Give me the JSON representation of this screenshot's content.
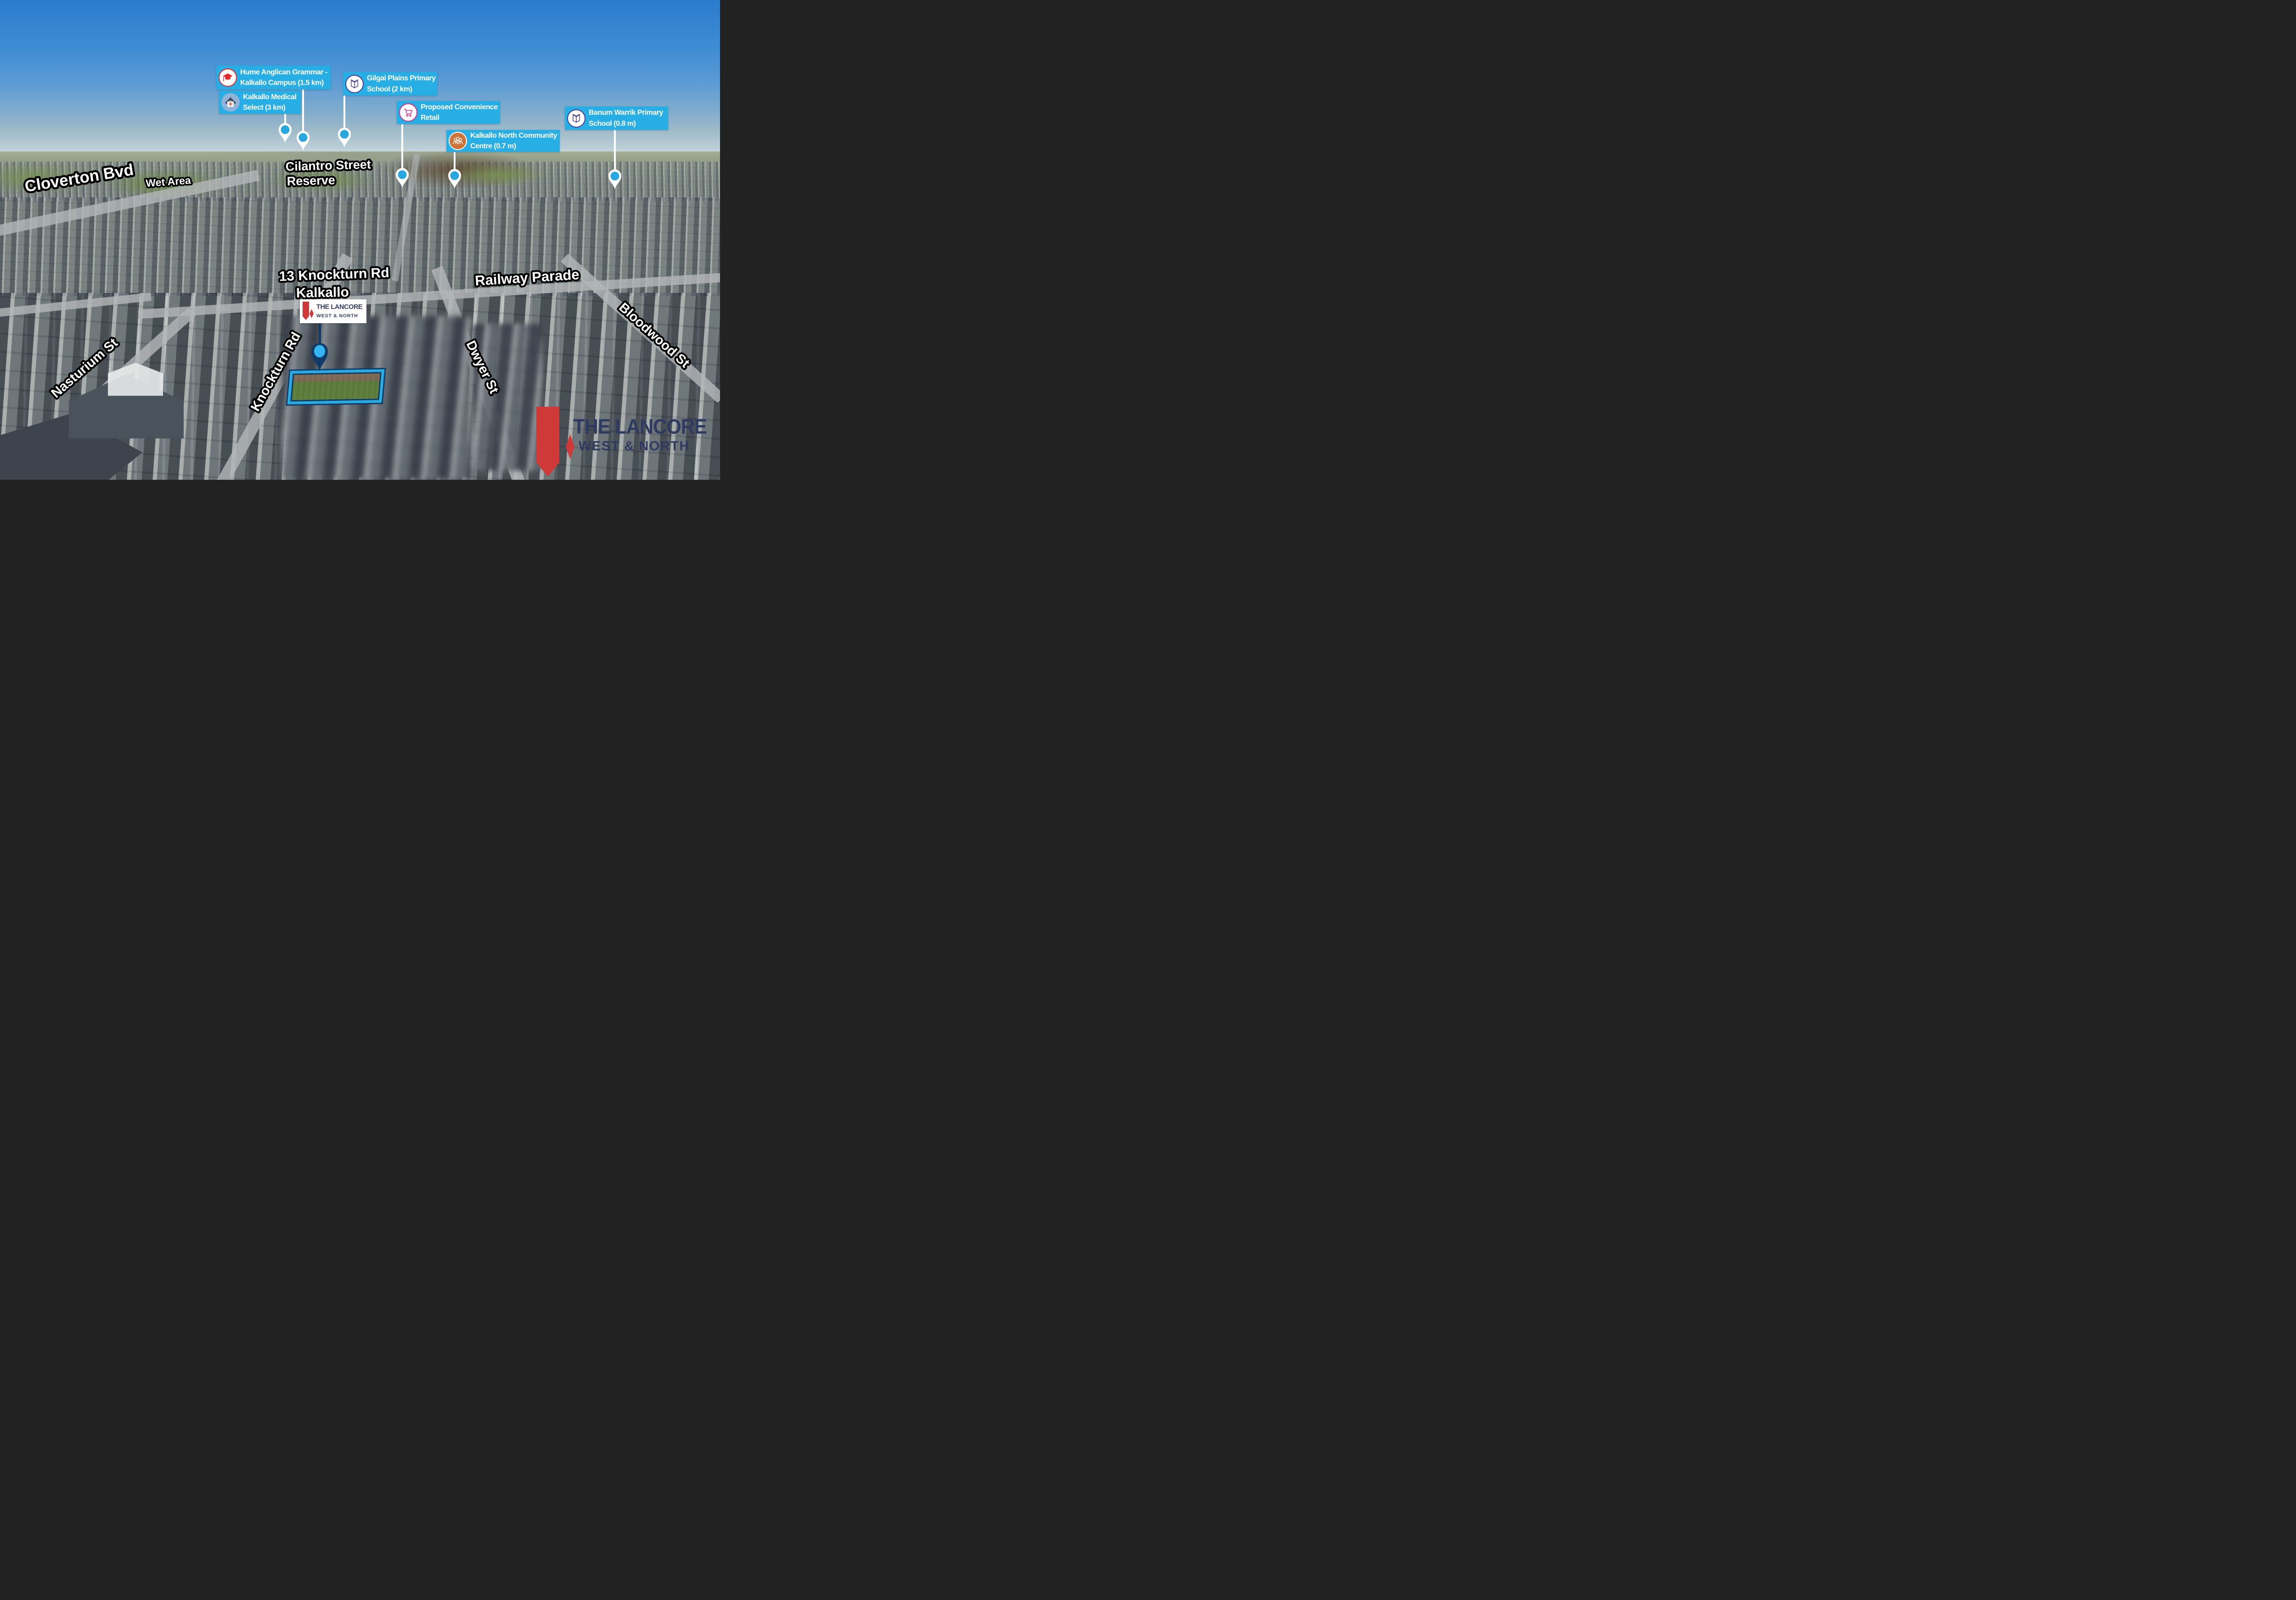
{
  "poi_labels": [
    {
      "id": "hume-anglican-grammar",
      "line1": "Hume Anglican Grammar -",
      "line2": "Kalkallo Campus (1.5 km)",
      "icon": "graduation-cap"
    },
    {
      "id": "kalkallo-medical",
      "line1": "Kalkallo Medical",
      "line2": "Select (3 km)",
      "icon": "medical-house"
    },
    {
      "id": "gilgai-plains",
      "line1": "Gilgai Plains Primary",
      "line2": "School (2 km)",
      "icon": "open-book"
    },
    {
      "id": "proposed-retail",
      "line1": "Proposed Convenience",
      "line2": "Retail",
      "icon": "shopping-cart"
    },
    {
      "id": "kalkallo-north-community",
      "line1": "Kalkallo North Community",
      "line2": "Centre (0.7 m)",
      "icon": "people-group"
    },
    {
      "id": "banum-warrik",
      "line1": "Banum Warrik Primary",
      "line2": "School (0.8 m)",
      "icon": "open-book"
    }
  ],
  "streets": {
    "cloverton": "Cloverton Bvd",
    "wet_area": "Wet Area",
    "cilantro_line1": "Cilantro Street",
    "cilantro_line2": "Reserve",
    "property_title": "13 Knockturn Rd",
    "property_suburb": "Kalkallo",
    "railway": "Railway Parade",
    "bloodwood": "Bloodwood St",
    "nasturium": "Nasturium St",
    "knockturn": "Knockturn Rd",
    "dwyer": "Dwyer St"
  },
  "branding": {
    "line1": "THE LANCORE",
    "line2": "WEST & NORTH"
  },
  "colors": {
    "label_bg": "#27aee4",
    "pin_white": "#ffffff",
    "pin_dot_blue": "#29a8e0",
    "marker_navy": "#123a66",
    "marker_light_blue": "#35b6f2",
    "brand_navy": "#333f63",
    "brand_red": "#cf3a38",
    "kalkallo_text_blue": "#4ac2f4",
    "street_text": "#ffffff",
    "street_outline": "#000000"
  }
}
